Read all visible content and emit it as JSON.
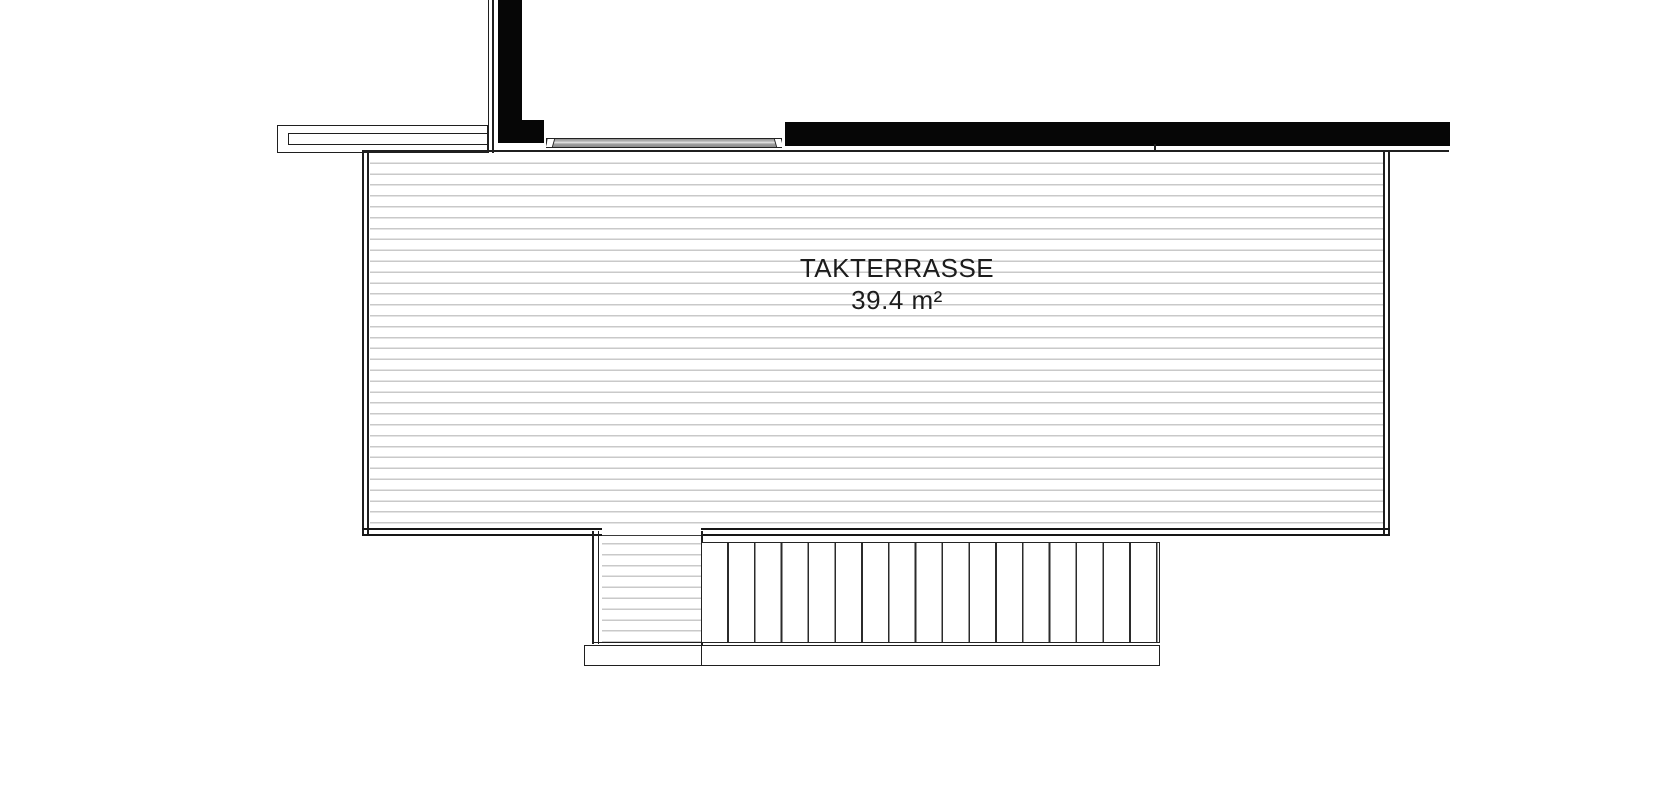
{
  "room": {
    "name": "TAKTERRASSE",
    "area": "39.4 m²"
  },
  "plan_elements": {
    "terrace_decking": "horizontal plank hatch",
    "stairs": "17 treads",
    "walls": "solid black poché",
    "door": "sliding door sill with jamb marks"
  },
  "colors": {
    "background": "#ffffff",
    "line_dark": "#1f1f1f",
    "wall_fill": "#060606",
    "decking_line": "#c9c9c9",
    "sill_gray": "#a6a6a6"
  }
}
